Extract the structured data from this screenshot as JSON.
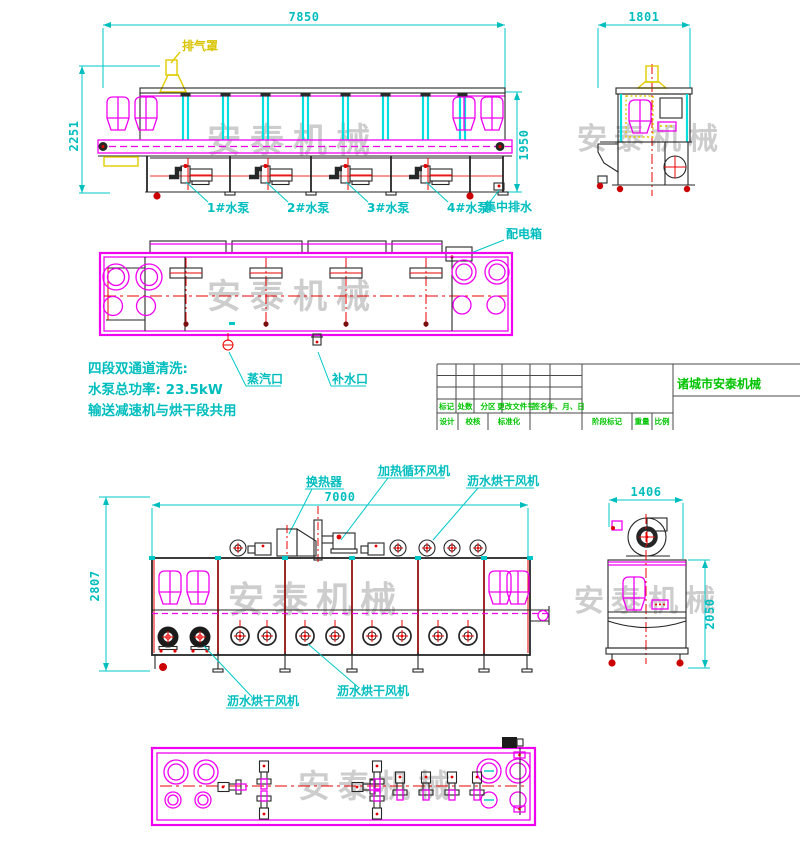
{
  "watermark": "安泰机械",
  "top_side_view": {
    "dim_width": "7850",
    "dim_height_left": "2251",
    "dim_height_right": "1950",
    "exhaust_label": "排气罩",
    "pump_labels": [
      "1#水泵",
      "2#水泵",
      "3#水泵",
      "4#水泵"
    ],
    "drain_label": "集中排水",
    "power_box_label": "配电箱"
  },
  "top_end_view": {
    "dim_width": "1801"
  },
  "plan_view": {
    "steam_label": "蒸汽口",
    "makeup_label": "补水口"
  },
  "notes": [
    "四段双通道清洗:",
    "水泵总功率: 23.5kW",
    "输送减速机与烘干段共用"
  ],
  "title_block": {
    "header_labels": [
      "标记",
      "处数",
      "分区",
      "更改文件号",
      "签名",
      "年、月、日"
    ],
    "bottom_labels": [
      "设计",
      "校核",
      "标准化",
      "阶段标记",
      "重量",
      "比例"
    ],
    "company": "诸城市安泰机械"
  },
  "bottom_side_view": {
    "dim_width": "7000",
    "dim_height": "2807",
    "heat_exchanger_label": "换热器",
    "heating_fan_label": "加热循环风机",
    "drying_fan_top_label": "沥水烘干风机",
    "drying_fan_bottom_labels": [
      "沥水烘干风机",
      "沥水烘干风机"
    ]
  },
  "bottom_end_view": {
    "dim_width": "1406",
    "dim_height": "2050"
  }
}
